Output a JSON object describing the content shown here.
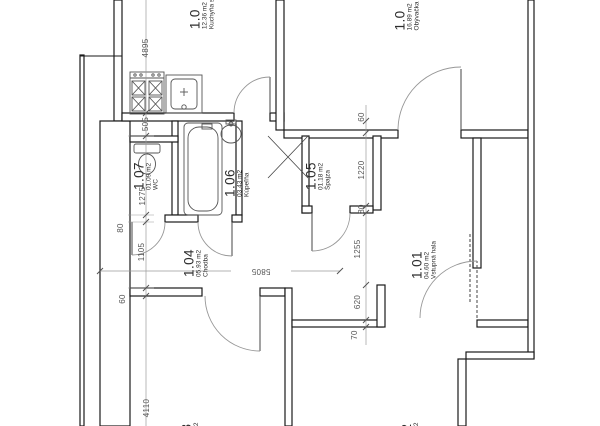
{
  "drawing": {
    "type": "architectural-floor-plan",
    "background": "#ffffff",
    "wall_color": "#1a1a1a",
    "dimension_color": "#8a8a8a",
    "text_color": "#2e2e2e"
  },
  "rooms": [
    {
      "key": "kitchen",
      "number": "1.0",
      "area": "12.36 m2",
      "name": "Kuchyňa s"
    },
    {
      "key": "living-room",
      "number": "1.0",
      "area": "16.89 m2",
      "name": "Obývačka"
    },
    {
      "key": "entry-hall",
      "number": "1.01",
      "area": "04.60 m2",
      "name": "Vstupná hala"
    },
    {
      "key": "hallway",
      "number": "1.04",
      "area": "05.93 m2",
      "name": "Chodba"
    },
    {
      "key": "pantry",
      "number": "1.05",
      "area": "01.18 m2",
      "name": "Špajza"
    },
    {
      "key": "bathroom",
      "number": "1.06",
      "area": "03.43 m2",
      "name": "Kúpeľňa"
    },
    {
      "key": "wc",
      "number": "1.07",
      "area": "01.09 m2",
      "name": "WC"
    },
    {
      "key": "room-bottom-left",
      "number": "3",
      "area": "m2",
      "name": ""
    },
    {
      "key": "room-bottom-right",
      "number": "2",
      "area": "m2",
      "name": ""
    }
  ],
  "dimensions": {
    "left": [
      "4895",
      "505",
      "1275",
      "80",
      "1105",
      "60",
      "4110"
    ],
    "right": [
      "60",
      "1220",
      "80",
      "1255",
      "620",
      "70"
    ],
    "overall": "5805"
  },
  "fixtures": [
    "stove",
    "kitchen-sink",
    "bathtub",
    "washbasin",
    "toilet",
    "ventilation-shaft"
  ]
}
